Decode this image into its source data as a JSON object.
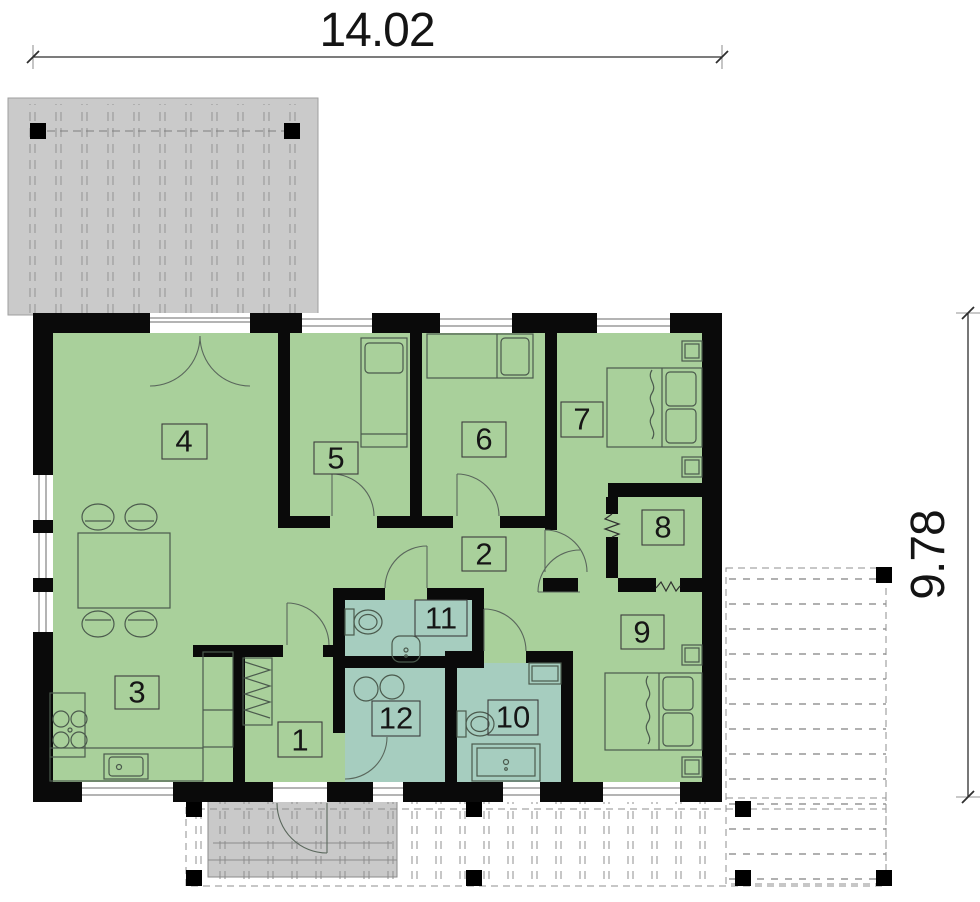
{
  "plan": {
    "title": "single-storey house floor plan",
    "width_dimension": "14.02",
    "height_dimension": "9.78",
    "rooms": [
      {
        "id": 1,
        "number": "1"
      },
      {
        "id": 2,
        "number": "2"
      },
      {
        "id": 3,
        "number": "3"
      },
      {
        "id": 4,
        "number": "4"
      },
      {
        "id": 5,
        "number": "5"
      },
      {
        "id": 6,
        "number": "6"
      },
      {
        "id": 7,
        "number": "7"
      },
      {
        "id": 8,
        "number": "8"
      },
      {
        "id": 9,
        "number": "9"
      },
      {
        "id": 10,
        "number": "10"
      },
      {
        "id": 11,
        "number": "11"
      },
      {
        "id": 12,
        "number": "12"
      }
    ]
  },
  "colors": {
    "floor_green": "#a9d09b",
    "wet_room_teal": "#a6cdbf",
    "wall_black": "#0a0a0a",
    "carport_gray": "#cacaca",
    "porch_gray": "#c4c4c4",
    "furniture_line": "#4b5a4d",
    "terrace_dash_gray": "#8f8f8f"
  }
}
